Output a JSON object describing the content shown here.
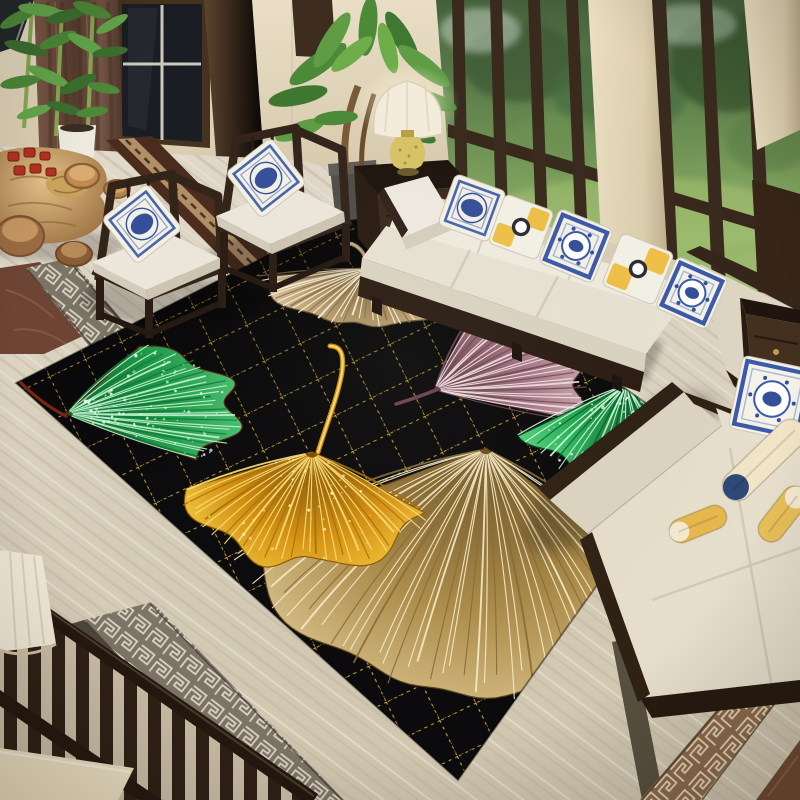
{
  "scene": {
    "label": "living-room-with-ginkgo-leaf-rug",
    "width": 800,
    "height": 800
  },
  "palette": {
    "rug_black": "#0b0a0c",
    "lattice_gold": "#b8962b",
    "lattice_bright": "#ecd061",
    "travertine": "#d9d0bf",
    "wall_beige": "#e0d4b8",
    "wood_dark": "#33241a",
    "wood_espresso": "#2b1d13",
    "cushion_white": "#efeade",
    "curtain_brown": "#6e4f41",
    "glass_green": "#6d9154",
    "pillow_blue": "#3b5aa8",
    "pillow_yellow": "#f0c149",
    "marble_band_brown": "#8a6a4c",
    "marble_band_grey": "#7c7466",
    "tea_set_red": "#b23222",
    "lamp_shade_cream": "#f6efdd",
    "lamp_base_yellow": "#d8c568",
    "plant_green": "#4c8a38",
    "root_table_gold": "#c89a55"
  },
  "rug": {
    "background": "#0b0a0c",
    "outline": [
      [
        16,
        383
      ],
      [
        365,
        206
      ],
      [
        700,
        441
      ],
      [
        458,
        780
      ]
    ],
    "lattice": {
      "color": "#b8962b",
      "bright": "#ecd061",
      "size": 40,
      "rotate": 64,
      "dash": "3 4.2",
      "dash_bright": "1.5 6.9"
    },
    "leaves": [
      {
        "name": "champagne-leaf-top",
        "ax": 368,
        "ay": 268,
        "dir": 97,
        "spread": 148,
        "r": 118,
        "squash": 0.52,
        "ribs": 40,
        "wobble": 0.05,
        "notch": 0.12,
        "bend": 0.14,
        "fill": [
          "#7a5f38",
          "#c2a778",
          "#eddcba"
        ],
        "rib": "#fbf3dd",
        "rib2": "#8a7248",
        "edge": "#6a5432",
        "stem": {
          "path": "M368,268 C366,256 362,248 352,244 Q344,242 346,250",
          "color": "#b89a60",
          "w": 4,
          "hl": "#e8d5a8"
        },
        "sparkles": 0,
        "sparkle_color": "#ffffff",
        "seed": 11
      },
      {
        "name": "mauve-leaf-right",
        "ax": 434,
        "ay": 390,
        "dir": -27,
        "spread": 94,
        "r": 160,
        "squash": 0.58,
        "ribs": 28,
        "wobble": 0.05,
        "notch": 0.05,
        "bend": 0.1,
        "fill": [
          "#5e3a44",
          "#a87888",
          "#d6b4bc"
        ],
        "rib": "#f4e2e6",
        "rib2": "#6e4852",
        "edge": "#4e2e36",
        "stem": {
          "path": "M436,390 Q416,398 396,404",
          "color": "#6b4450",
          "w": 3.5
        },
        "sparkles": 0,
        "sparkle_color": "#ffffff",
        "seed": 22
      },
      {
        "name": "green-leaf-right",
        "ax": 626,
        "ay": 384,
        "dir": 84,
        "spread": 130,
        "r": 130,
        "squash": 0.8,
        "ribs": 30,
        "wobble": 0.07,
        "notch": 0.1,
        "bend": 0.1,
        "fill": [
          "#0a6a30",
          "#2cb85c",
          "#6ade92"
        ],
        "rib": "#d2ffde",
        "rib2": "#0b5e2c",
        "edge": "#064a20",
        "stem": {
          "path": "M628,386 Q634,372 628,362",
          "color": "#0a5a28",
          "w": 3
        },
        "sparkles": 70,
        "sparkle_color": "#eafff2",
        "seed": 33
      },
      {
        "name": "green-leaf-left",
        "ax": 66,
        "ay": 414,
        "dir": -13,
        "spread": 102,
        "r": 182,
        "squash": 0.45,
        "ribs": 32,
        "wobble": 0.05,
        "notch": 0.07,
        "bend": 0.12,
        "fill": [
          "#0b6a2e",
          "#1fa04a",
          "#55cc7c"
        ],
        "rib": "#c4f4d0",
        "rib2": "#0e7a36",
        "edge": "#5a1d10",
        "stem": {
          "path": "M66,416 C50,408 34,396 20,382",
          "color": "#7a2415",
          "w": 3.2
        },
        "sparkles": 85,
        "sparkle_color": "#eafff2",
        "seed": 44
      },
      {
        "name": "tan-leaf-bottom",
        "ax": 486,
        "ay": 448,
        "dir": 99,
        "spread": 118,
        "r": 290,
        "squash": 0.9,
        "ribs": 46,
        "wobble": 0.04,
        "notch": 0.08,
        "bend": 0.2,
        "fill": [
          "#6b521f",
          "#b3924f",
          "#e6d09a"
        ],
        "rib": "#f7ecc9",
        "rib2": "#8a6c38",
        "edge": "#5c4518",
        "stem": null,
        "sparkles": 0,
        "sparkle_color": "#ffffff",
        "seed": 55
      },
      {
        "name": "gold-leaf-center",
        "ax": 312,
        "ay": 452,
        "dir": 97,
        "spread": 126,
        "r": 150,
        "squash": 0.8,
        "ribs": 36,
        "wobble": 0.06,
        "notch": 0.1,
        "bend": 0.12,
        "fill": [
          "#7a4e04",
          "#d89310",
          "#ffd54a"
        ],
        "rib": "#ffe27a",
        "rib2": "#a86f08",
        "edge": "#8a5c06",
        "stem": {
          "path": "M318,452 C328,420 338,396 342,372 C344,356 342,346 330,346",
          "color": "#c8890a",
          "w": 5,
          "hl": "#ffd96a"
        },
        "sparkles": 45,
        "sparkle_color": "#fff3b8",
        "seed": 66
      }
    ]
  },
  "furniture": {
    "chairs": [
      {
        "dx": 0,
        "dy": 0
      },
      {
        "dx": 124,
        "dy": -46
      }
    ],
    "chair_pillow": {
      "cx": 142,
      "cy": 224,
      "s": 58,
      "rot": -38,
      "style": "blue-frame"
    }
  },
  "decor": {
    "pillows": [
      {
        "target": "sofa",
        "cx": 472,
        "cy": 208,
        "s": 54,
        "rot": 20,
        "style": "blue-frame"
      },
      {
        "target": "sofa",
        "cx": 521,
        "cy": 227,
        "s": 52,
        "rot": 20,
        "style": "yellow-patch"
      },
      {
        "target": "sofa",
        "cx": 576,
        "cy": 246,
        "s": 58,
        "rot": 22,
        "style": "blue-heavy"
      },
      {
        "target": "sofa",
        "cx": 638,
        "cy": 269,
        "s": 56,
        "rot": 22,
        "style": "yellow-patch"
      },
      {
        "target": "sofa",
        "cx": 692,
        "cy": 293,
        "s": 56,
        "rot": 24,
        "style": "blue-heavy"
      },
      {
        "target": "rightchair",
        "cx": 772,
        "cy": 399,
        "s": 74,
        "rot": 12,
        "style": "blue-heavy"
      }
    ],
    "toys": [
      {
        "cx": 764,
        "cy": 460,
        "len": 104,
        "w": 30,
        "rot": -44,
        "body": "#f2e5c6",
        "tip": "#2e4878",
        "tip_end": "start"
      },
      {
        "cx": 783,
        "cy": 514,
        "len": 64,
        "w": 26,
        "rot": -52,
        "body": "#e8c05a",
        "tip": "#f4ead0",
        "tip_end": "end"
      },
      {
        "cx": 698,
        "cy": 524,
        "len": 60,
        "w": 24,
        "rot": -22,
        "body": "#e6b84e",
        "tip": "#f4ead0",
        "tip_end": "start"
      }
    ]
  },
  "railing": {
    "count": 13,
    "spacing": 24,
    "width": 13,
    "x0": 4,
    "top_y": 584,
    "slope": 0.69,
    "color": "#2e2015"
  },
  "objects": [
    "window-wall-with-garden-view",
    "brown-curtains",
    "bamboo-plant",
    "carved-root-tea-table",
    "wooden-stump-stools",
    "ming-style-armchairs",
    "blue-white-porcelain-pillows",
    "table-lamp",
    "side-cabinet",
    "cream-sofa",
    "yellow-accent-pillows",
    "nightstand",
    "upholstered-armchair",
    "plush-toys",
    "black-gold-lattice-rug",
    "ginkgo-leaf-pattern",
    "marble-floor-greek-key-border",
    "wood-railing"
  ]
}
